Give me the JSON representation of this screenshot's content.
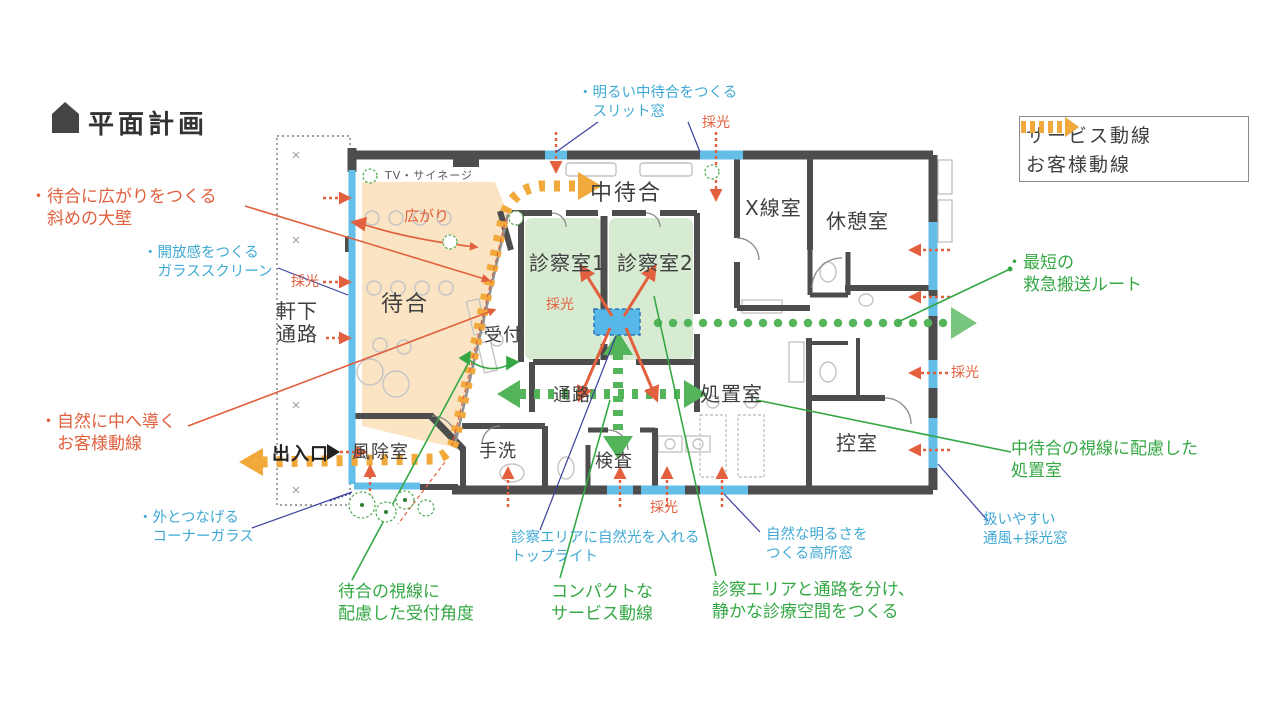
{
  "title": "平面計画",
  "legend": {
    "items": [
      {
        "label": "サービス動線",
        "color": "#4db052"
      },
      {
        "label": "お客様動線",
        "color": "#f2a93b"
      }
    ]
  },
  "rooms": {
    "naka_machiai": "中待合",
    "xray": "X線室",
    "kyukei": "休憩室",
    "shinsatsu1": "診察室1",
    "shinsatsu2": "診察室2",
    "machiai": "待合",
    "uketsuke": "受付",
    "tsuro": "通路",
    "shochi": "処置室",
    "hikae": "控室",
    "tearai": "手洗",
    "kensa": "検査",
    "fujo": "風除室",
    "nokishita": "軒下\n通路",
    "deiriguchi": "出入口",
    "tv_signage": "TV・サイネージ"
  },
  "labels": {
    "saiko": "採光",
    "hirogari": "広がり"
  },
  "annotations": {
    "orange": {
      "diagonal_wall": "・待合に広がりをつくる\n　斜めの大壁",
      "customer_route": "・自然に中へ導く\n　お客様動線"
    },
    "blue": {
      "slit_window": "・明るい中待合をつくる\n　スリット窓",
      "glass_screen": "・開放感をつくる\n　ガラススクリーン",
      "corner_glass": "・外とつなげる\n　コーナーガラス",
      "toplight": "診察エリアに自然光を入れる\nトップライト",
      "high_window": "自然な明るさを\nつくる高所窓",
      "vent_window": "扱いやすい\n通風+採光窓"
    },
    "green": {
      "emergency": "・最短の\n　救急搬送ルート",
      "treatment": "中待合の視線に配慮した\n処置室",
      "reception_angle": "待合の視線に\n配慮した受付角度",
      "service_line": "コンパクトな\nサービス動線",
      "quiet_area": "診察エリアと通路を分け、\n静かな診療空間をつくる"
    }
  },
  "colors": {
    "wall": "#4d4d4d",
    "waiting_fill": "#fae4c4",
    "consult_fill": "#d7ebd3",
    "window_glass": "#63bee8",
    "customer_flow": "#f2a93b",
    "service_flow": "#54b45a",
    "annotation_orange": "#e2603d",
    "annotation_blue": "#3fa9d4",
    "annotation_green": "#35a845",
    "leader_navy": "#3b3f9e"
  }
}
